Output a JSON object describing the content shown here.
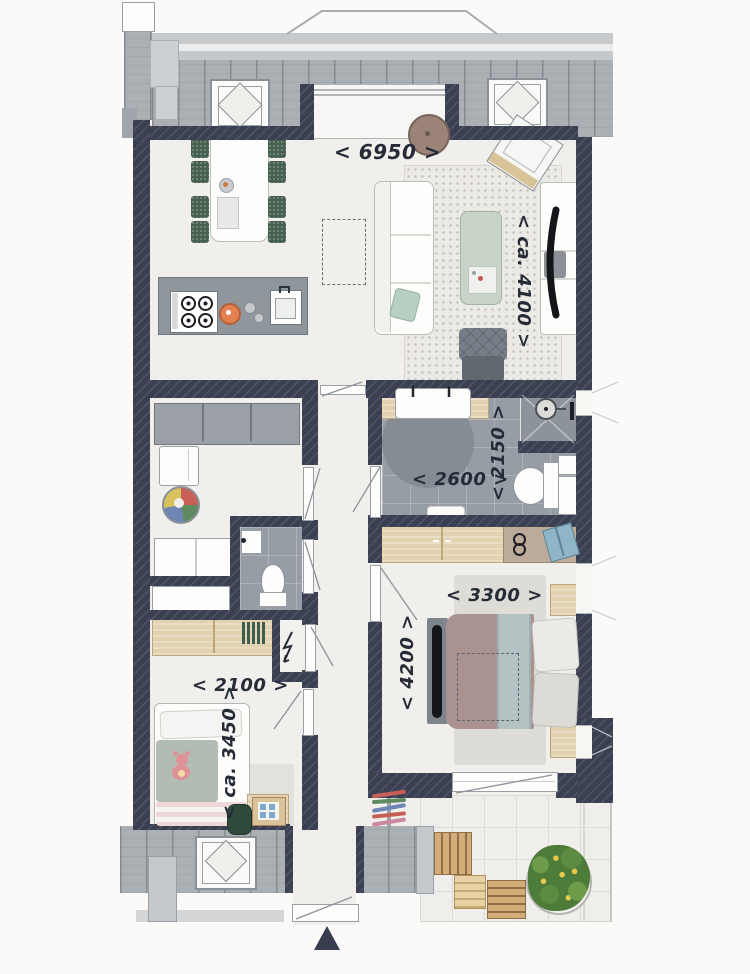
{
  "dimensions": {
    "living_width": "<  6950  >",
    "living_depth": "< ca. 4100 >",
    "bathroom_width": "< 2600 >",
    "shower_depth": "< 2150 >",
    "bedroom_width": "< 3300 >",
    "bedroom_depth": "< 4200 >",
    "childroom_width": "< 2100 >",
    "childroom_depth": "< ca. 3450 >"
  },
  "palette": {
    "wall": "#3a3f52",
    "floor": "#f1efeb",
    "balcony_plank": "#abb0b4",
    "bath_tile": "#979da5",
    "wood": "#e2d2b0",
    "chair_green": "#45604f",
    "counter_gray": "#8f969c",
    "accent_orange": "#e2814f",
    "plant_green": "#4d7b39",
    "bed_taupe": "#a99290",
    "throw_blue": "#b5c2c4",
    "teddy_pink": "#de9297",
    "label_ink": "#262b38"
  },
  "icons": {
    "north_arrow": "up-triangle",
    "meter_symbol": "lightning-zigzag",
    "shower_head": "circle-drain",
    "roof_window": "diamond-frame"
  }
}
